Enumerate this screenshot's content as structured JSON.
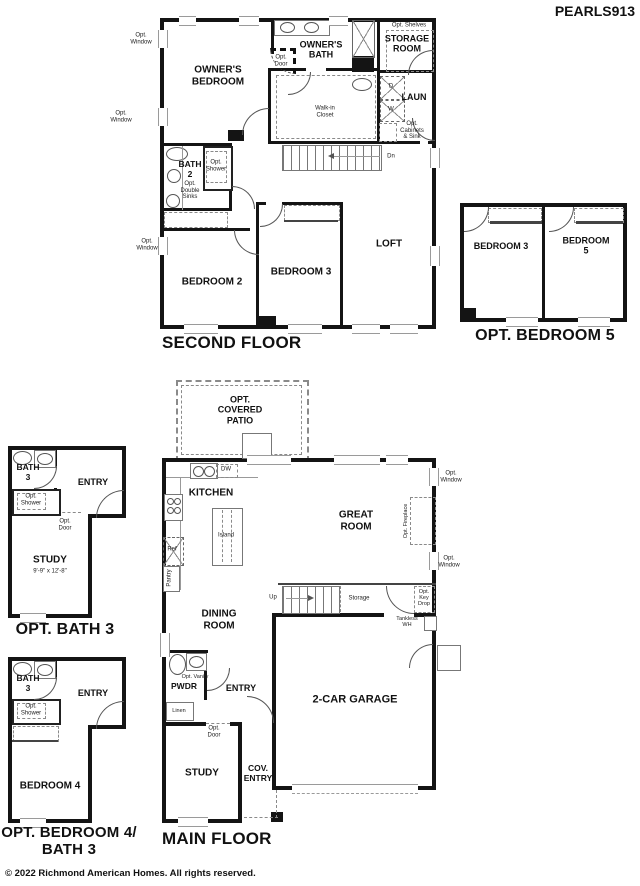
{
  "title": "PEARLS913",
  "footer": "© 2022 Richmond American Homes. All rights reserved.",
  "shared": {
    "opt_window": "Opt.\nWindow",
    "opt_door": "Opt.\nDoor",
    "opt_shower": "Opt.\nShower"
  },
  "floors": {
    "second": {
      "caption": "SECOND FLOOR",
      "rooms": {
        "owners_bedroom": "OWNER'S\nBEDROOM",
        "owners_bath": "OWNER'S\nBATH",
        "storage_room": "STORAGE\nROOM",
        "laundry": "LAUN",
        "walk_in_closet": "Walk-in\nCloset",
        "bath_2": "BATH\n2",
        "bedroom_2": "BEDROOM 2",
        "bedroom_3": "BEDROOM 3",
        "loft": "LOFT"
      },
      "features": {
        "opt_shelves": "Opt. Shelves",
        "opt_cabinets_sink": "Opt.\nCabinets\n& Sink",
        "opt_double_sinks": "Opt.\nDouble\nSinks",
        "dryer": "D",
        "washer": "W",
        "down": "Dn"
      }
    },
    "opt_bedroom_5": {
      "caption": "OPT. BEDROOM 5",
      "rooms": {
        "bedroom_3": "BEDROOM 3",
        "bedroom_5": "BEDROOM 5"
      }
    },
    "main": {
      "caption": "MAIN FLOOR",
      "rooms": {
        "kitchen": "KITCHEN",
        "great_room": "GREAT\nROOM",
        "dining_room": "DINING\nROOM",
        "powder": "PWDR",
        "entry": "ENTRY",
        "study": "STUDY",
        "covered_entry": "COV.\nENTRY",
        "garage": "2-CAR GARAGE",
        "opt_covered_patio": "OPT.\nCOVERED\nPATIO"
      },
      "features": {
        "dishwasher": "DW",
        "island": "Island",
        "refrigerator": "Ref",
        "pantry": "Pantry",
        "up": "Up",
        "storage": "Storage",
        "opt_key_drop": "Opt.\nKey\nDrop",
        "tankless_wh": "Tankless\nWH",
        "opt_vanity": "Opt. Vanity",
        "linen": "Linen",
        "opt_fireplace": "Opt. Fireplace"
      }
    },
    "opt_bath_3": {
      "caption": "OPT. BATH 3",
      "rooms": {
        "bath_3": "BATH\n3",
        "entry": "ENTRY",
        "study": "STUDY"
      },
      "study_dimensions": "9'-9\" x 12'-8\""
    },
    "opt_bedroom_4": {
      "caption": "OPT. BEDROOM 4/\nBATH 3",
      "rooms": {
        "bath_3": "BATH\n3",
        "entry": "ENTRY",
        "bedroom_4": "BEDROOM 4"
      }
    }
  }
}
